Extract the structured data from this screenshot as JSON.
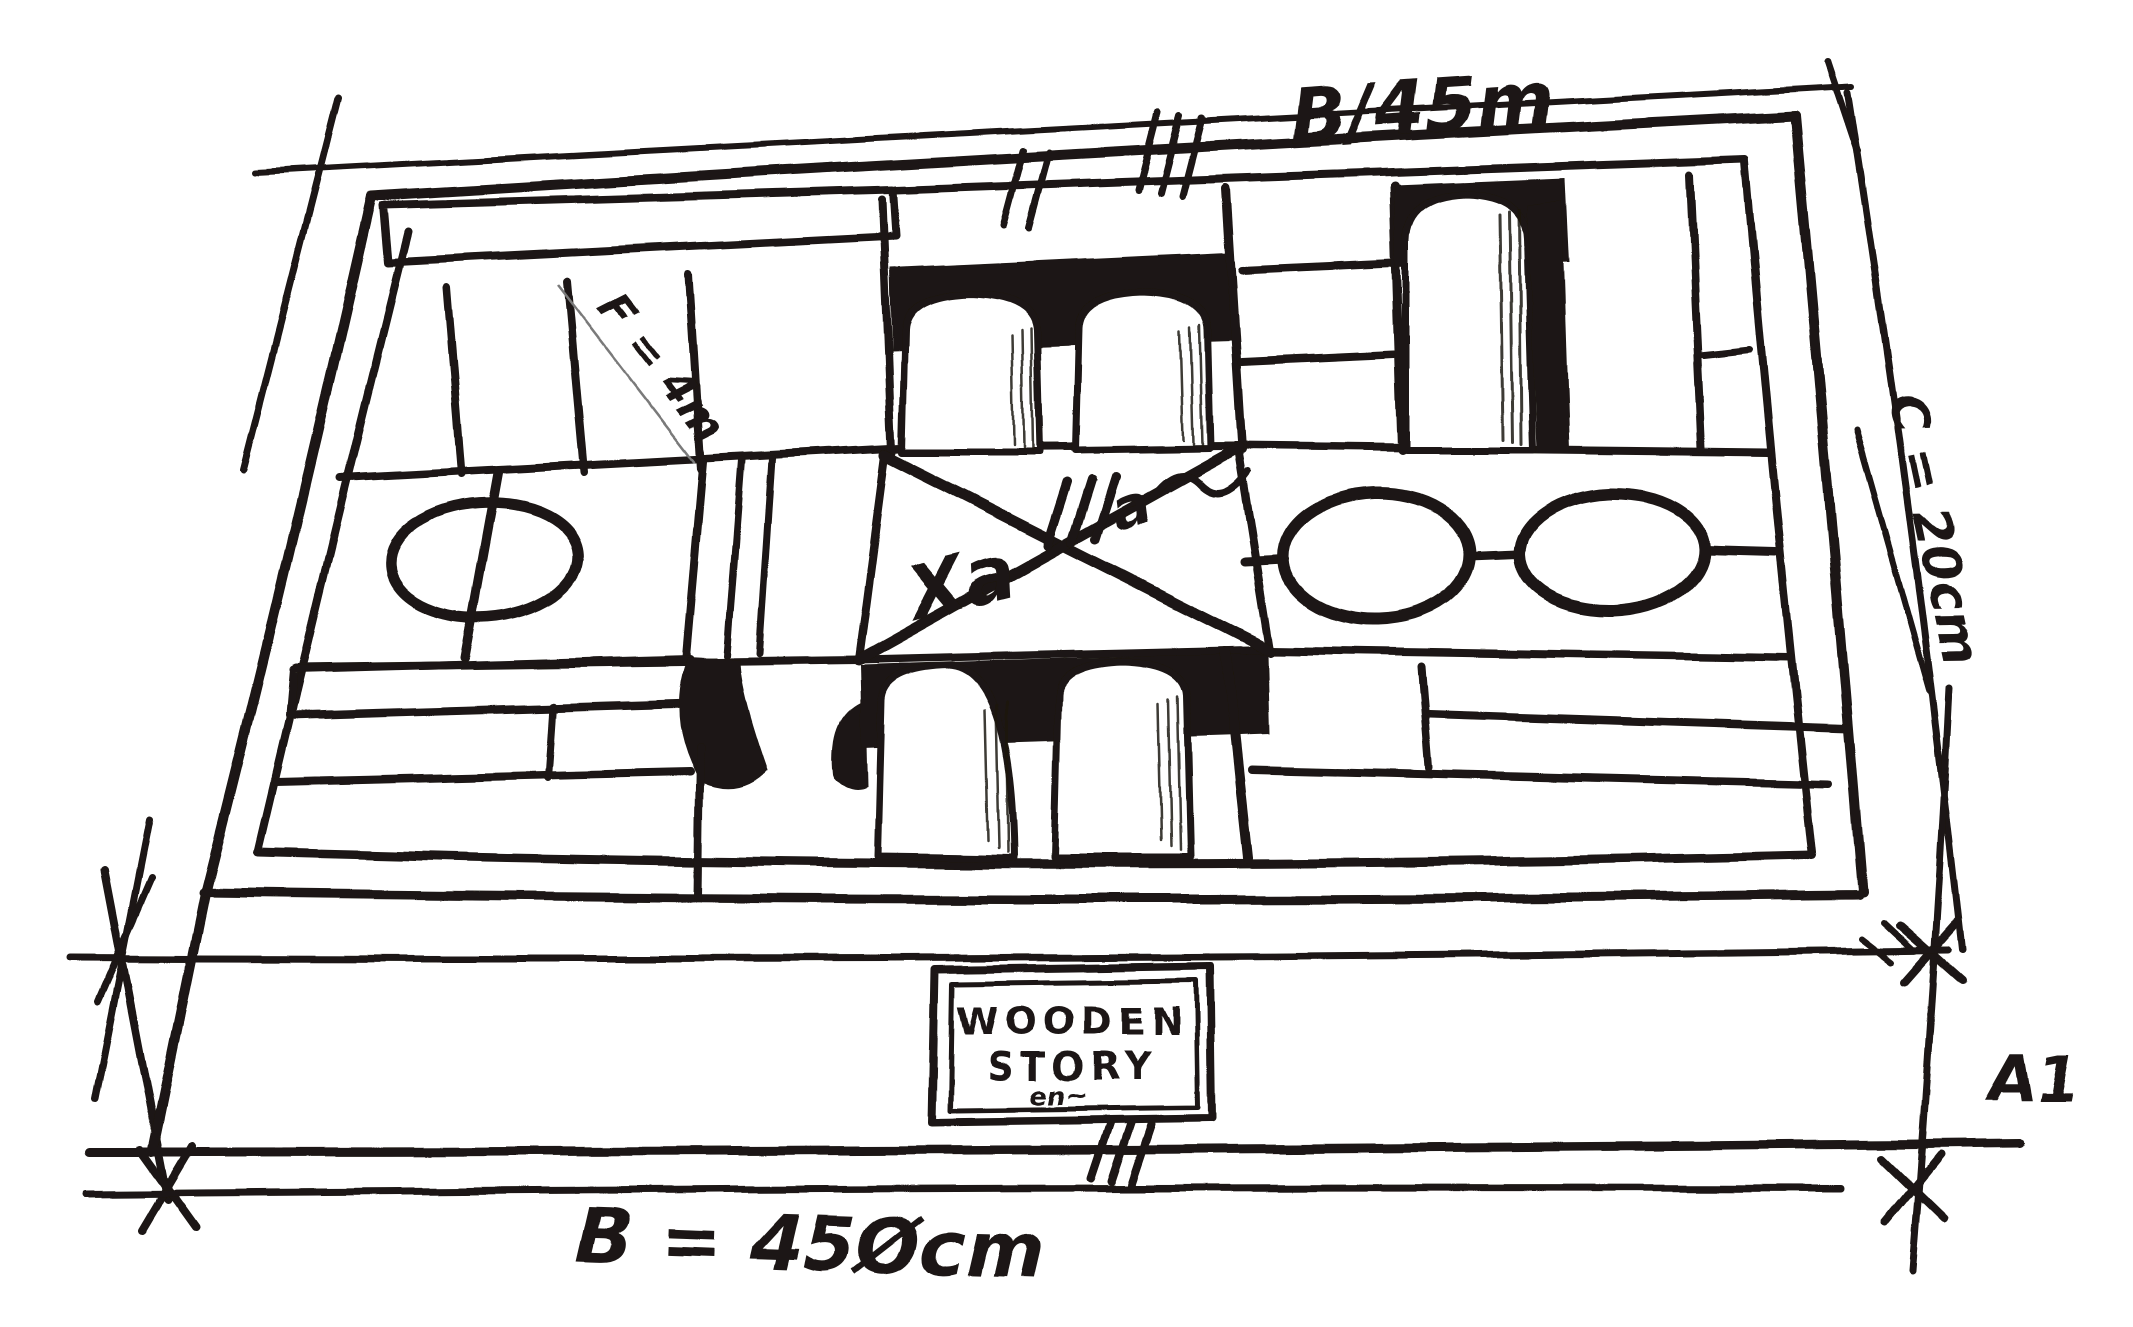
{
  "title": "Wooden blocks box — hand-drawn dimension sketch",
  "colors": {
    "ink": "#1b1712",
    "paper": "#ffffff",
    "pencil": "#7a7a7a"
  },
  "brand_label": {
    "line1": "WOODEN",
    "line2": "STORY",
    "scribble": "en~"
  },
  "annotations": {
    "top_width": "B/45m",
    "right_depth": "C = 20cm",
    "height_mark": "A1",
    "bottom_width": "B = 45Øcm",
    "block_note": "F = 4m",
    "center_mark": "Xa",
    "center_tally": "III",
    "center_tally_mark": "a"
  }
}
